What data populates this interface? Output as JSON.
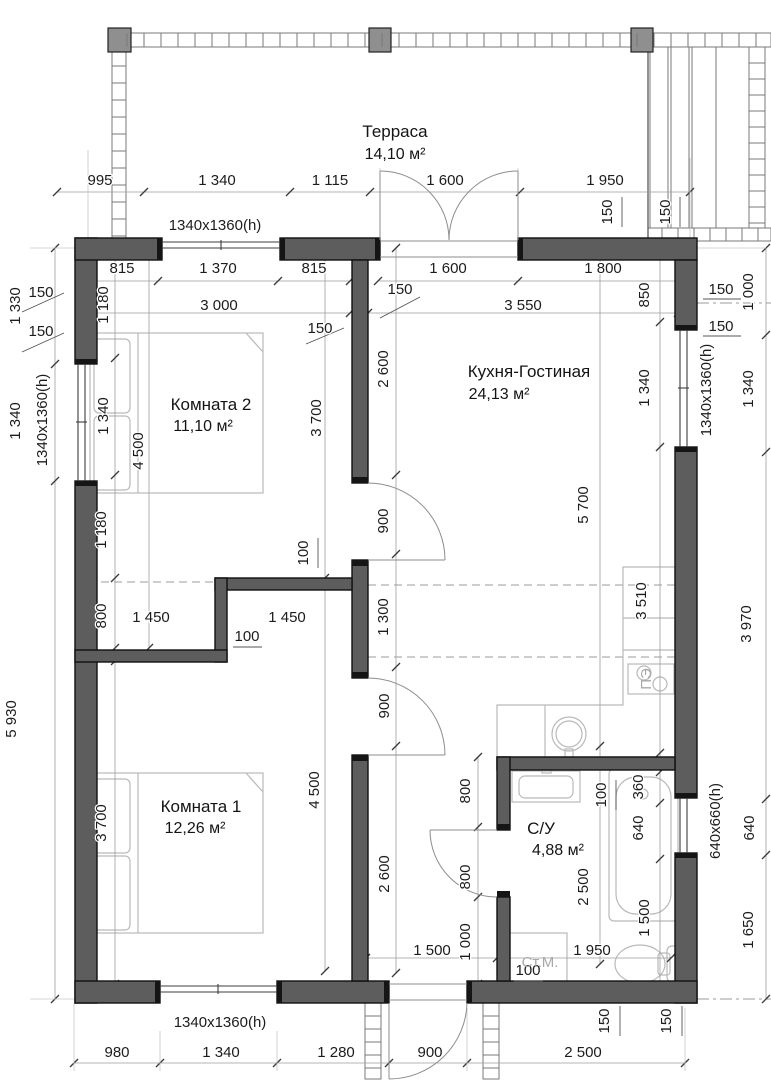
{
  "plan": {
    "title": "План дома",
    "rooms": [
      {
        "name": "Терраса",
        "area": "14,10 м²",
        "x": 395,
        "y": 137,
        "ax": 395,
        "ay": 159
      },
      {
        "name": "Комната 2",
        "area": "11,10 м²",
        "x": 211,
        "y": 410,
        "ax": 203,
        "ay": 431
      },
      {
        "name": "Кухня-Гостиная",
        "area": "24,13 м²",
        "x": 529,
        "y": 377,
        "ax": 499,
        "ay": 399
      },
      {
        "name": "Комната 1",
        "area": "12,26 м²",
        "x": 201,
        "y": 812,
        "ax": 195,
        "ay": 833
      },
      {
        "name": "С/У",
        "area": "4,88 м²",
        "x": 541,
        "y": 834,
        "ax": 558,
        "ay": 855
      }
    ],
    "labels": [
      {
        "t": "995",
        "x": 100,
        "y": 185
      },
      {
        "t": "1 340",
        "x": 217,
        "y": 185
      },
      {
        "t": "1 115",
        "x": 330,
        "y": 185
      },
      {
        "t": "1 600",
        "x": 445,
        "y": 185
      },
      {
        "t": "1 950",
        "x": 605,
        "y": 185
      },
      {
        "t": "1340x1360(h)",
        "x": 215,
        "y": 230
      },
      {
        "t": "150",
        "x": 612,
        "y": 212,
        "r": -90
      },
      {
        "t": "150",
        "x": 670,
        "y": 212,
        "r": -90
      },
      {
        "t": "815",
        "x": 122,
        "y": 273
      },
      {
        "t": "1 370",
        "x": 218,
        "y": 273
      },
      {
        "t": "815",
        "x": 314,
        "y": 273
      },
      {
        "t": "1 600",
        "x": 448,
        "y": 273
      },
      {
        "t": "1 800",
        "x": 603,
        "y": 273
      },
      {
        "t": "150",
        "x": 41,
        "y": 297
      },
      {
        "t": "150",
        "x": 41,
        "y": 336
      },
      {
        "t": "3 000",
        "x": 219,
        "y": 310
      },
      {
        "t": "3 550",
        "x": 523,
        "y": 310
      },
      {
        "t": "150",
        "x": 400,
        "y": 294
      },
      {
        "t": "150",
        "x": 320,
        "y": 333
      },
      {
        "t": "850",
        "x": 649,
        "y": 295,
        "r": -90
      },
      {
        "t": "150",
        "x": 721,
        "y": 294
      },
      {
        "t": "150",
        "x": 721,
        "y": 331
      },
      {
        "t": "1 000",
        "x": 753,
        "y": 292,
        "r": -90
      },
      {
        "t": "1 330",
        "x": 20,
        "y": 306,
        "r": -90
      },
      {
        "t": "1 340",
        "x": 20,
        "y": 421,
        "r": -90
      },
      {
        "t": "1340x1360(h)",
        "x": 47,
        "y": 420,
        "r": -90
      },
      {
        "t": "5 930",
        "x": 16,
        "y": 719,
        "r": -90
      },
      {
        "t": "1 180",
        "x": 108,
        "y": 305,
        "r": -90
      },
      {
        "t": "1 340",
        "x": 108,
        "y": 416,
        "r": -90
      },
      {
        "t": "4 500",
        "x": 143,
        "y": 451,
        "r": -90
      },
      {
        "t": "1 180",
        "x": 106,
        "y": 530,
        "r": -90
      },
      {
        "t": "800",
        "x": 106,
        "y": 616,
        "r": -90
      },
      {
        "t": "3 700",
        "x": 106,
        "y": 823,
        "r": -90
      },
      {
        "t": "3 700",
        "x": 321,
        "y": 418,
        "r": -90
      },
      {
        "t": "4 500",
        "x": 319,
        "y": 790,
        "r": -90
      },
      {
        "t": "2 600",
        "x": 388,
        "y": 369,
        "r": -90
      },
      {
        "t": "900",
        "x": 388,
        "y": 521,
        "r": -90
      },
      {
        "t": "1 300",
        "x": 388,
        "y": 617,
        "r": -90
      },
      {
        "t": "900",
        "x": 389,
        "y": 706,
        "r": -90
      },
      {
        "t": "2 600",
        "x": 389,
        "y": 874,
        "r": -90
      },
      {
        "t": "1 450",
        "x": 151,
        "y": 622
      },
      {
        "t": "1 450",
        "x": 287,
        "y": 622
      },
      {
        "t": "100",
        "x": 247,
        "y": 641
      },
      {
        "t": "100",
        "x": 308,
        "y": 553,
        "r": -90
      },
      {
        "t": "5 700",
        "x": 588,
        "y": 505,
        "r": -90
      },
      {
        "t": "1 340",
        "x": 649,
        "y": 388,
        "r": -90
      },
      {
        "t": "1340x1360(h)",
        "x": 711,
        "y": 390,
        "r": -90
      },
      {
        "t": "1 340",
        "x": 753,
        "y": 389,
        "r": -90
      },
      {
        "t": "3 510",
        "x": 646,
        "y": 601,
        "r": -90
      },
      {
        "t": "3 970",
        "x": 751,
        "y": 624,
        "r": -90
      },
      {
        "t": "800",
        "x": 470,
        "y": 791,
        "r": -90
      },
      {
        "t": "800",
        "x": 470,
        "y": 877,
        "r": -90
      },
      {
        "t": "1 000",
        "x": 470,
        "y": 942,
        "r": -90
      },
      {
        "t": "2 500",
        "x": 588,
        "y": 887,
        "r": -90
      },
      {
        "t": "100",
        "x": 606,
        "y": 795,
        "r": -90
      },
      {
        "t": "360",
        "x": 643,
        "y": 787,
        "r": -90
      },
      {
        "t": "640",
        "x": 643,
        "y": 828,
        "r": -90
      },
      {
        "t": "1 500",
        "x": 649,
        "y": 918,
        "r": -90
      },
      {
        "t": "1 950",
        "x": 592,
        "y": 955
      },
      {
        "t": "1 500",
        "x": 432,
        "y": 955
      },
      {
        "t": "100",
        "x": 528,
        "y": 975
      },
      {
        "t": "640x660(h)",
        "x": 720,
        "y": 821,
        "r": -90
      },
      {
        "t": "640",
        "x": 754,
        "y": 828,
        "r": -90
      },
      {
        "t": "1 650",
        "x": 753,
        "y": 930,
        "r": -90
      },
      {
        "t": "150",
        "x": 609,
        "y": 1021,
        "r": -90
      },
      {
        "t": "150",
        "x": 671,
        "y": 1021,
        "r": -90
      },
      {
        "t": "1340x1360(h)",
        "x": 220,
        "y": 1027
      },
      {
        "t": "980",
        "x": 117,
        "y": 1057
      },
      {
        "t": "1 340",
        "x": 221,
        "y": 1057
      },
      {
        "t": "1 280",
        "x": 336,
        "y": 1057
      },
      {
        "t": "900",
        "x": 430,
        "y": 1057
      },
      {
        "t": "2 500",
        "x": 583,
        "y": 1057
      },
      {
        "t": "Ст.М.",
        "x": 540,
        "y": 967,
        "s": 12,
        "c": "light"
      },
      {
        "t": "ПЭ",
        "x": 651,
        "y": 679,
        "r": -90,
        "s": 9,
        "c": "light"
      }
    ],
    "colors": {
      "wall": "#5d5d5d",
      "wall_outline": "#111111",
      "post": "#8f8f8f",
      "dim_text": "#1c1c1c",
      "fixture": "#b9b9b9",
      "dash": "#9b9b9b",
      "dim_line": "#9e9e9e",
      "tick": "#3a3a3a",
      "struct": "#7a7a7a",
      "light_text": "#a8a8a8"
    }
  }
}
